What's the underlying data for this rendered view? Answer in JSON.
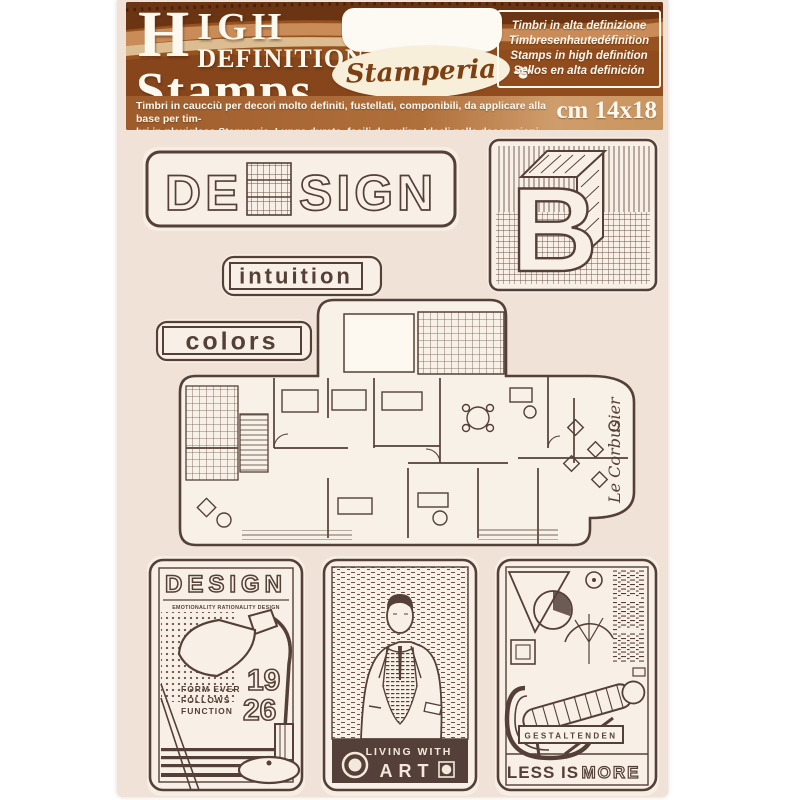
{
  "header": {
    "title_word1": "HIGH",
    "title_word2": "DEFINITION",
    "title_word3": "Stamps",
    "brand": "Stamperia",
    "translations": [
      "Timbri in alta definizione",
      "Timbresenhautedéfinition",
      "Stamps in high definition",
      "Sellos en alta definición"
    ],
    "description_line1": "Timbri in caucciù per decori molto definiti, fustellati, componibili, da applicare alla base per tim-",
    "description_line2": "bri in plexiglass Stamperia. Lunga durata, facili da pulire. Ideali nelle decorazioni Scrapbooking!",
    "size_label": "cm 14x18"
  },
  "stamps": {
    "design_word": {
      "left": "DE",
      "right": "SIGN"
    },
    "letter_block": {
      "letter": "B"
    },
    "intuition": {
      "label": "intuition"
    },
    "colors": {
      "label": "colors"
    },
    "floorplan": {
      "signature": "Le Corbusier"
    },
    "poster_design": {
      "title": "DESIGN",
      "subtitle": "EMOTIONALITY RATIONALITY DESIGN",
      "year_top": "19",
      "year_bottom": "26",
      "slogan": [
        "FORM EVER",
        "FOLLOWS",
        "FUNCTION"
      ]
    },
    "poster_art": {
      "banner_top": "LIVING WITH",
      "banner_main": "ART"
    },
    "poster_chair": {
      "badge": "GESTALTENDEN",
      "slogan_left": "LESS IS",
      "slogan_right": "MORE"
    }
  },
  "colors": {
    "ink": "#544039",
    "paper": "#f0e2d6",
    "stamp_paper": "#f8f0e6",
    "header_base": "#96521f",
    "header_dark": "#5f2d10",
    "header_light": "#c98c59",
    "header_cream": "#e8d0a6",
    "text_on_brown": "#fdf9ef"
  }
}
